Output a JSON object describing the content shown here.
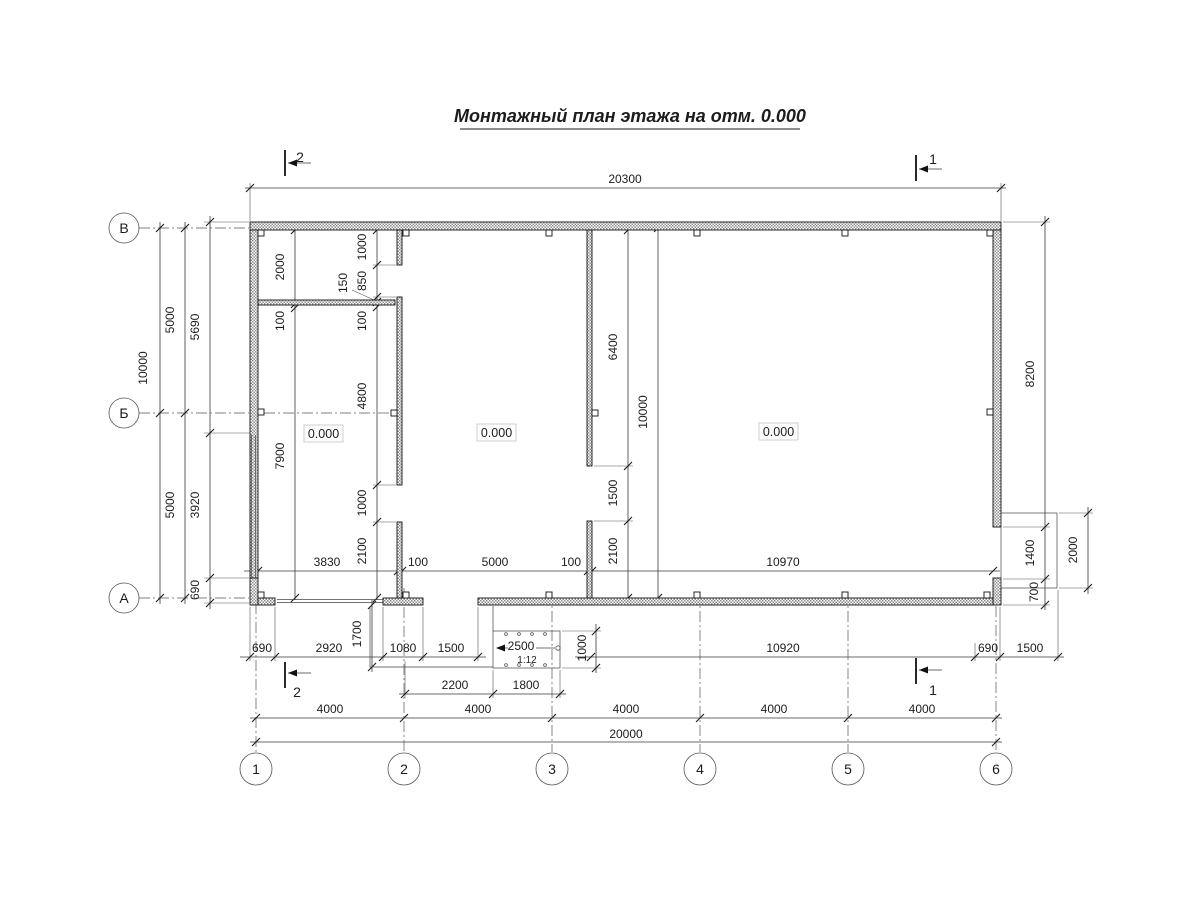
{
  "title": "Монтажный план этажа на отм. 0.000",
  "axes": {
    "rows": [
      "В",
      "Б",
      "А"
    ],
    "cols": [
      "1",
      "2",
      "3",
      "4",
      "5",
      "6"
    ]
  },
  "sections": {
    "top2": "2",
    "top1": "1",
    "bottom2": "2",
    "bottom1": "1"
  },
  "levels": [
    "0.000",
    "0.000",
    "0.000"
  ],
  "ramp": {
    "len": "2500",
    "slope": "1:12"
  },
  "dims": {
    "top_overall": "20300",
    "chain": [
      "3830",
      "100",
      "5000",
      "100",
      "10970"
    ],
    "row1": [
      "690",
      "2920",
      "1080",
      "1500",
      "10920",
      "690",
      "1500"
    ],
    "row2": [
      "2200",
      "1800"
    ],
    "spans": [
      "4000",
      "4000",
      "4000",
      "4000",
      "4000"
    ],
    "bottom_overall": "20000",
    "left_total": "10000",
    "left_axis": [
      "5000",
      "5000"
    ],
    "left_wall": [
      "5690",
      "3920",
      "690"
    ],
    "room1": [
      "2000",
      "100",
      "7900"
    ],
    "p1": [
      "1000",
      "850",
      "150",
      "100",
      "4800",
      "1000",
      "2100"
    ],
    "p2": [
      "6400",
      "1500",
      "2100"
    ],
    "mid_total": "10000",
    "platform": "1700",
    "ramp_w": "1000",
    "right": [
      "8200",
      "1400",
      "700"
    ],
    "porch": "2000"
  }
}
